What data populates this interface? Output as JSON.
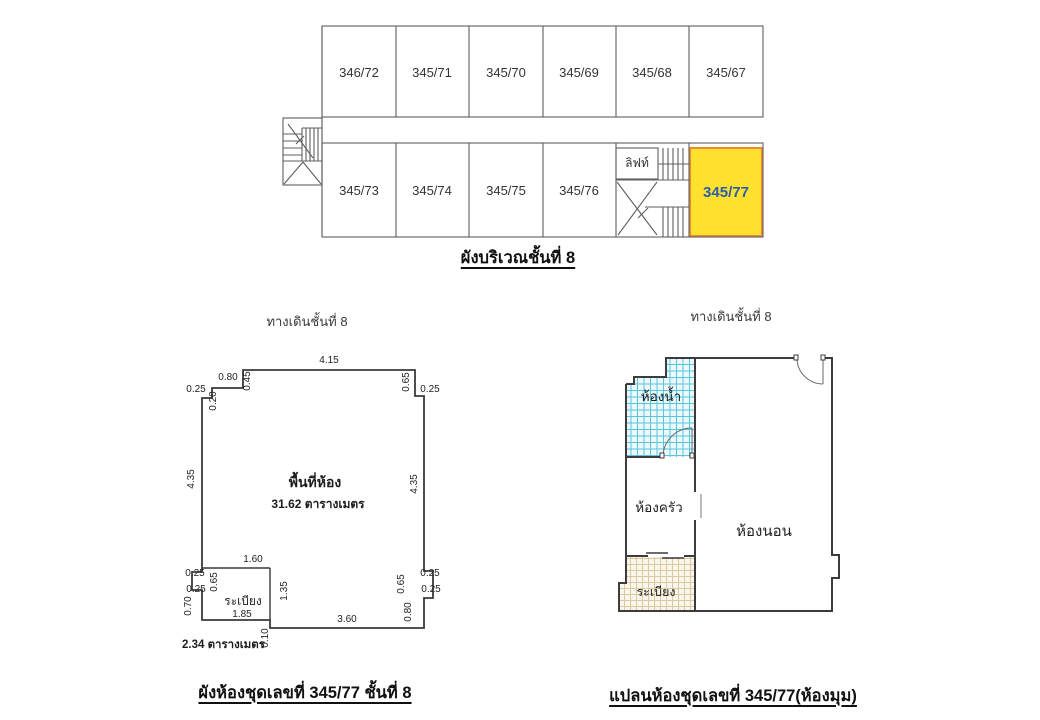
{
  "building_plan": {
    "caption": "ผังบริเวณชั้นที่ 8",
    "top_row_units": [
      "346/72",
      "345/71",
      "345/70",
      "345/69",
      "345/68",
      "345/67"
    ],
    "bottom_row_units": [
      "345/73",
      "345/74",
      "345/75",
      "345/76"
    ],
    "lift_label": "ลิฟท์",
    "highlight_unit": {
      "label": "345/77",
      "fill_color": "#ffe12e",
      "border_color": "#f08a2e",
      "label_color": "#2d5da9"
    }
  },
  "dimension_plan": {
    "walkway_label": "ทางเดินชั้นที่ 8",
    "caption": "ผังห้องชุดเลขที่ 345/77 ชั้นที่ 8",
    "room_area_title": "พื้นที่ห้อง",
    "room_area_value": "31.62 ตารางเมตร",
    "balcony_label": "ระเบียง",
    "balcony_area_value": "2.34 ตารางเมตร",
    "dims": {
      "top_width": "4.15",
      "tl_step_width": "0.80",
      "tl_step_drop": "0.45",
      "tl_corner": "0.25",
      "tl_step_drop2": "0.20",
      "left_height": "4.35",
      "tr_step_drop": "0.65",
      "tr_corner": "0.25",
      "right_height": "4.35",
      "balcony_top_width": "1.60",
      "bl_pillar_out": "0.25",
      "bl_pillar_height": "0.65",
      "bl_pillar_in": "0.25",
      "balcony_left_height": "0.70",
      "balcony_bottom_width": "1.85",
      "balcony_right_height": "1.35",
      "balcony_step": "0.10",
      "bottom_width": "3.60",
      "br_pillar_out": "0.25",
      "br_pillar_height": "0.65",
      "br_pillar_in": "0.25",
      "br_wall_below": "0.80"
    }
  },
  "layout_plan": {
    "walkway_label": "ทางเดินชั้นที่ 8",
    "caption": "แปลนห้องชุดเลขที่ 345/77(ห้องมุม)",
    "bathroom_label": "ห้องน้ำ",
    "kitchen_label": "ห้องครัว",
    "bedroom_label": "ห้องนอน",
    "balcony_label": "ระเบียง",
    "bathroom_hatch_line": "#56c6dd",
    "bathroom_hatch_bg": "#ecf8fb",
    "balcony_hatch_line": "#dbc9a4",
    "balcony_hatch_bg": "#fbf6ec"
  }
}
